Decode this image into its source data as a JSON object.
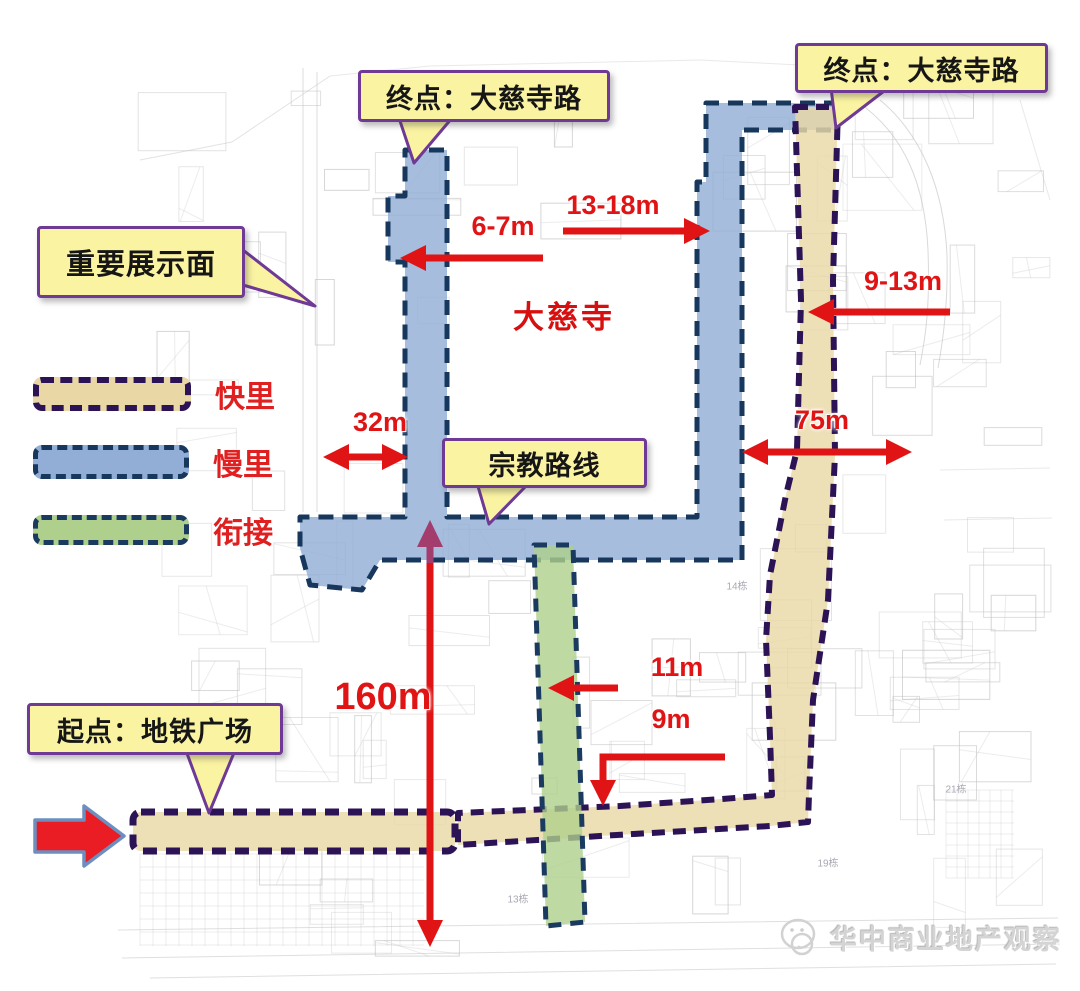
{
  "callouts": {
    "end_west": "终点：大慈寺路",
    "end_east": "终点：大慈寺路",
    "display_face": "重要展示面",
    "religious_route": "宗教路线",
    "start": "起点：地铁广场"
  },
  "legend": {
    "items": [
      {
        "label": "快里",
        "fill": "#e9d8a6",
        "stroke": "#2c1356"
      },
      {
        "label": "慢里",
        "fill": "#92aed6",
        "stroke": "#17375d"
      },
      {
        "label": "衔接",
        "fill": "#afd08c",
        "stroke": "#1b3a60"
      }
    ]
  },
  "map": {
    "place_label": "大慈寺",
    "measurements": {
      "west_lane": "6-7m",
      "north_lane": "13-18m",
      "east_lane": "9-13m",
      "west_block": "32m",
      "east_block": "75m",
      "link_lane": "11m",
      "south_lane": "9m",
      "main_axis": "160m"
    },
    "building_labels": [
      "13栋",
      "14栋",
      "19栋",
      "21栋"
    ]
  },
  "watermark": {
    "text": "华中商业地产观察"
  },
  "colors": {
    "arrow_red": "#e01414",
    "arrow_purple": "#a23d6e",
    "callout_bg": "#faf3a2",
    "callout_border": "#6f3996",
    "kuaili_fill": "#e9d8a6",
    "kuaili_stroke": "#2c1356",
    "manli_fill": "#92aed6",
    "manli_stroke": "#17375d",
    "xianjie_fill": "#afd08c",
    "xianjie_stroke": "#1b3a60"
  }
}
